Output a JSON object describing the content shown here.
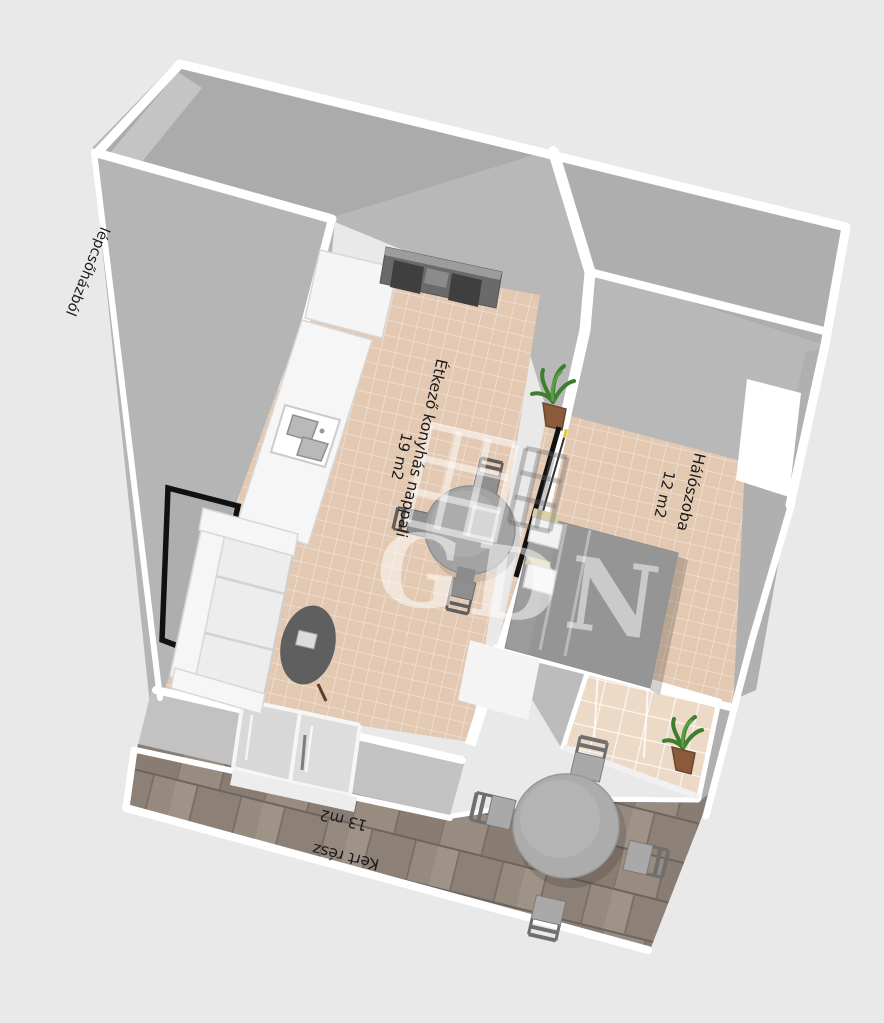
{
  "scene": {
    "background_color": "#e9e9e9",
    "wall_face_color": "#b5b5b5",
    "wall_top_color": "#ffffff",
    "tile_floor_color": "#e3c8b2",
    "deck_plank_color": "#958879",
    "black_door_color": "#111111",
    "plant_pot_color": "#8a5a3a",
    "plant_leaf_color": "#3f7d2f"
  },
  "rooms": {
    "staircase_label": "lépcsőházból",
    "living": {
      "name": "Étkező konyhás nappali",
      "area": "19 m2"
    },
    "bedroom": {
      "name": "Hálószoba",
      "area": "12 m2"
    },
    "garden": {
      "name": "Kert rész",
      "area": "13 m2"
    }
  },
  "watermark": {
    "text": "GDN"
  },
  "furniture": {
    "kitchen": [
      "tall-cabinet",
      "counter",
      "sink"
    ],
    "living": [
      "tv-stand",
      "wall-tv",
      "sofa",
      "coffee-table",
      "dining-table",
      "dining-chairs",
      "potted-plant"
    ],
    "bedroom": [
      "double-bed",
      "pillows",
      "sliding-glass-door",
      "window"
    ],
    "garden": [
      "outdoor-table",
      "outdoor-chairs",
      "potted-plant",
      "wood-deck"
    ]
  }
}
